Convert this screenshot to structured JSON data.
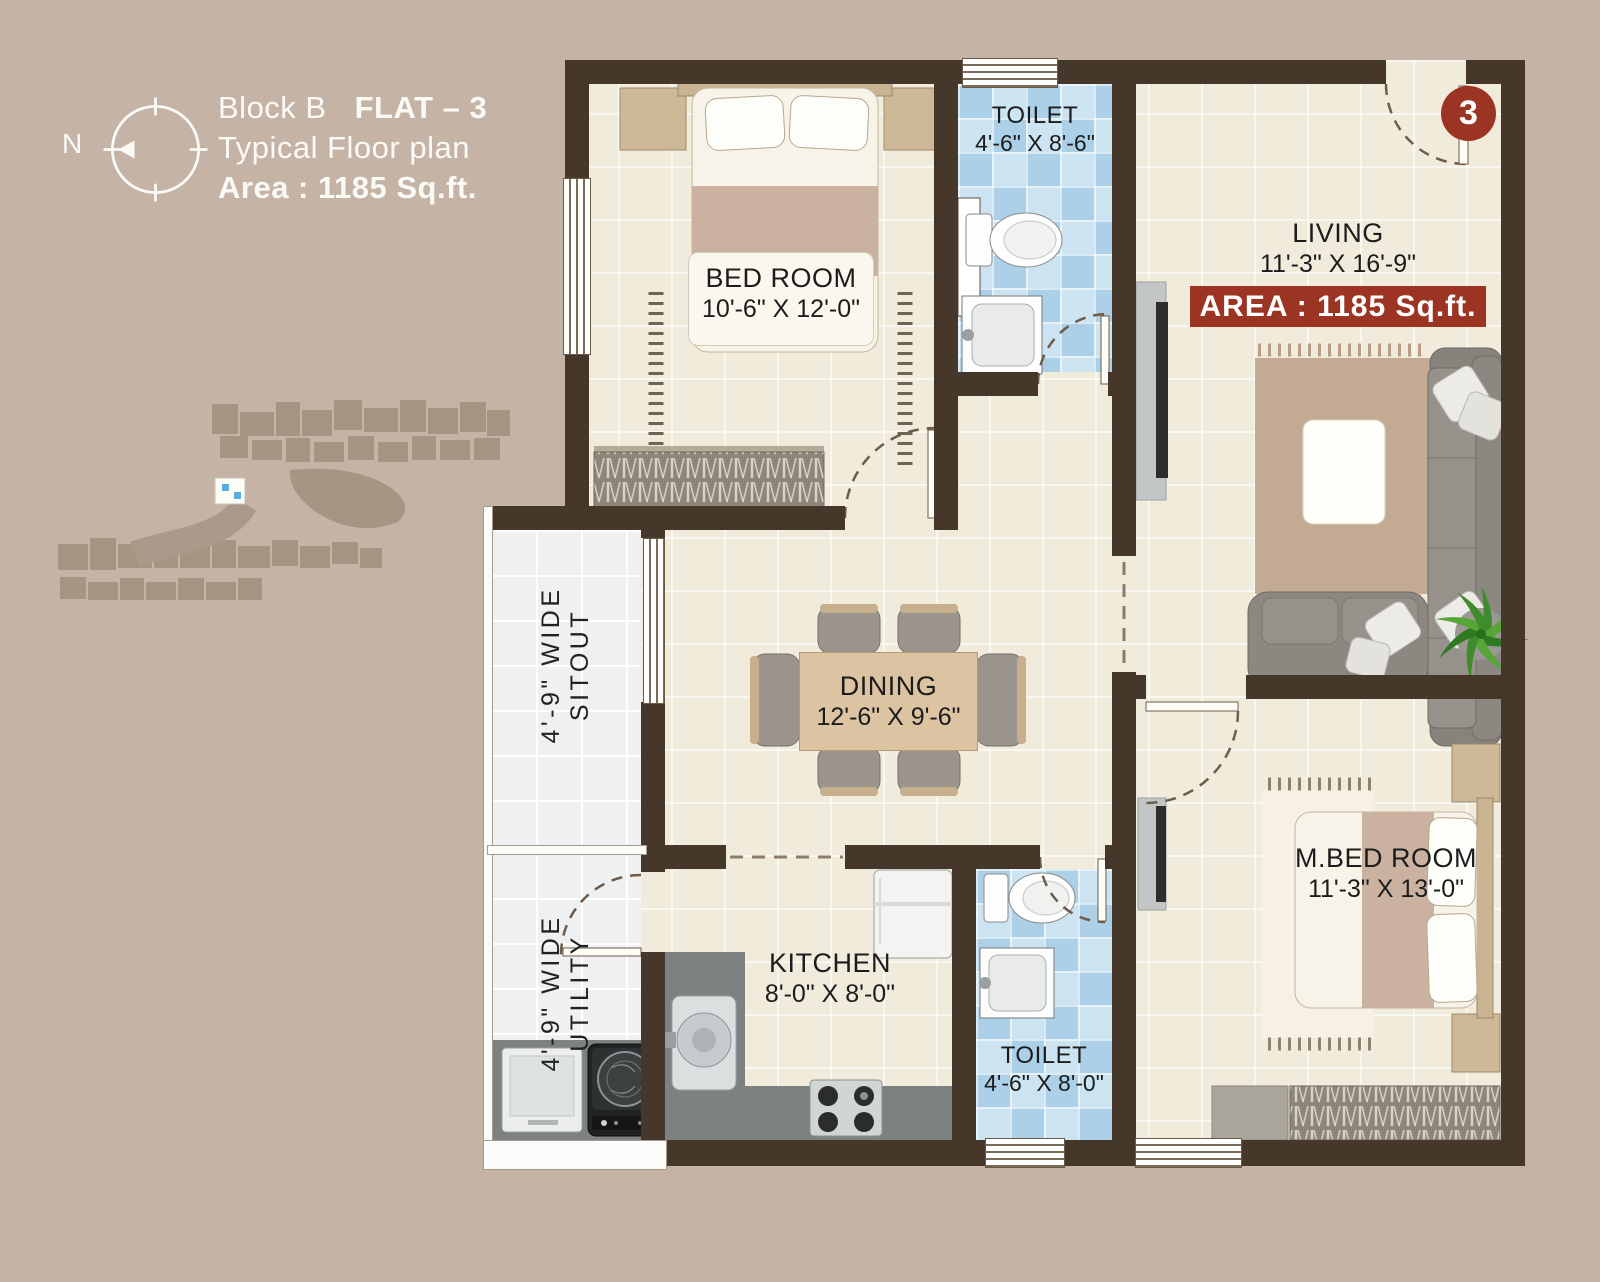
{
  "header": {
    "compass_label": "N",
    "block": "Block B",
    "flat": "FLAT – 3",
    "subtitle": "Typical Floor plan",
    "area": "Area : 1185 Sq.ft."
  },
  "flat_number_badge": "3",
  "area_banner": "AREA : 1185 Sq.ft.",
  "rooms": {
    "bedroom": {
      "name": "BED ROOM",
      "dims": "10'-6\" X 12'-0\""
    },
    "toilet_top": {
      "name": "TOILET",
      "dims": "4'-6\" X 8'-6\""
    },
    "living": {
      "name": "LIVING",
      "dims": "11'-3\" X 16'-9\""
    },
    "dining": {
      "name": "DINING",
      "dims": "12'-6\" X 9'-6\""
    },
    "sitout": {
      "width_label": "4'-9\" WIDE",
      "name": "SITOUT"
    },
    "utility": {
      "width_label": "4'-9\" WIDE",
      "name": "UTILITY"
    },
    "kitchen": {
      "name": "KITCHEN",
      "dims": "8'-0\" X 8'-0\""
    },
    "toilet_bottom": {
      "name": "TOILET",
      "dims": "4'-6\" X 8'-0\""
    },
    "master_bedroom": {
      "name": "M.BED ROOM",
      "dims": "11'-3\" X 13'-0\""
    }
  },
  "colors": {
    "background": "#c5b4a6",
    "wall": "#46372b",
    "floor_cream": "#f1ebdb",
    "floor_white": "#eef0f1",
    "toilet_blue": "#b9d9ec",
    "accent_red": "#9c3423",
    "text": "#1c1c1c",
    "title_text": "#fbfaf7"
  },
  "icons": {
    "compass": "compass-rose-icon",
    "site_map": "site-key-map"
  }
}
